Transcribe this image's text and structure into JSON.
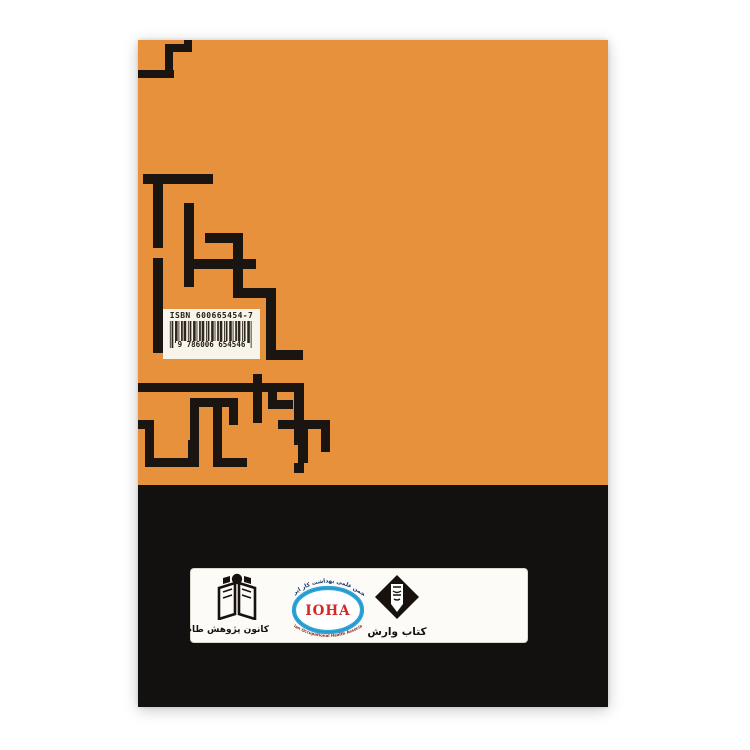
{
  "cover": {
    "barcode": {
      "isbn_label": "ISBN 600665454-7",
      "digits": "9 786006 654546"
    },
    "logo_band": {
      "taam": {
        "label": "کانون پژوهش طام"
      },
      "ioha": {
        "acronym": "IOHA",
        "top_text": "انجمن علمی بهداشت کار ایران",
        "bottom_text": "Iranian Occupational Health Association"
      },
      "varesh": {
        "label": "کتاب وارش"
      }
    },
    "colors": {
      "orange": "#E8913C",
      "cover_black": "#131010",
      "maze_black": "#1B1511",
      "ioha_blue": "#2FA5D8",
      "ioha_red": "#CE2B24"
    }
  }
}
